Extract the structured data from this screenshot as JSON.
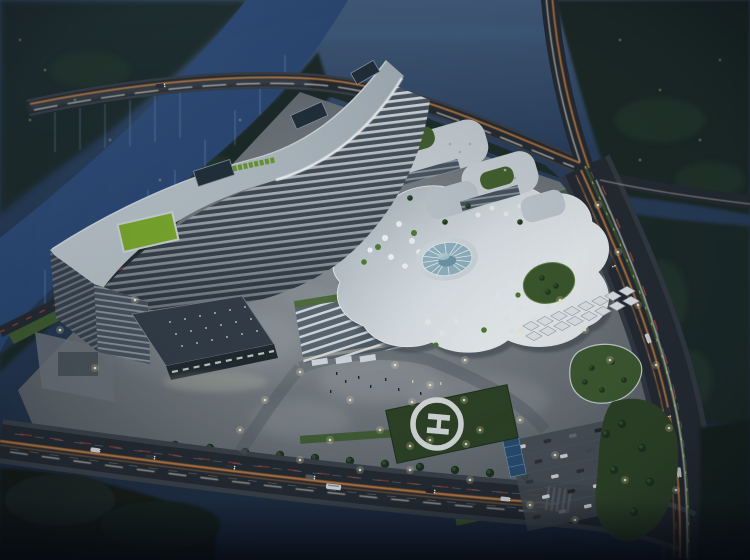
{
  "helipad": {
    "marking": "H"
  },
  "palette": {
    "sky_top": "#2e4767",
    "sky_mid": "#273a54",
    "sky_bottom": "#1d2b3f",
    "water_deep": "#223d66",
    "water_light": "#3a5c8e",
    "forest": "#1e2b25",
    "road": "#262c33",
    "plaza": "#878e94",
    "roof_white": "#cdd6dc",
    "roof_bright": "#eef2f4",
    "facade_stripe": "#dde4e9",
    "facade_gap": "#4e5a64",
    "green_roof": "#7cac2e",
    "lawn": "#2f4527",
    "courtyard": "#3f5d31",
    "dome_glass": "#8fb0bd",
    "canopy_white": "#e6ebee",
    "trail_orange": "#d08440",
    "trail_white": "#e9e6da",
    "trail_red": "#b0493a",
    "light_warm": "#f5eecb",
    "sign_green": "#6a9a30",
    "solar_blue": "#2b4f73",
    "helipad_white": "#dfe3e2"
  }
}
